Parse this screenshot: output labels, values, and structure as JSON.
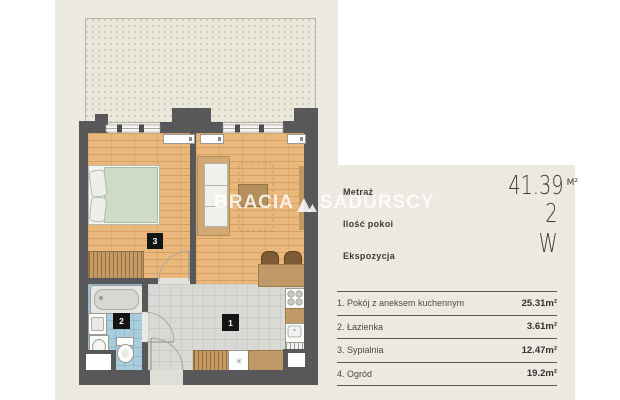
{
  "colors": {
    "background": "#ece9e1",
    "wall": "#58585a",
    "wood_floor": "#ebb87c",
    "tile_gray": "#d9d9d6",
    "tile_blue": "#a8cede",
    "garden_fill": "#eae7db",
    "furniture_brown": "#c09a66",
    "label_black": "#141414"
  },
  "watermark": {
    "left": "BRACIA",
    "right": "SADURSCY",
    "logo": "triangles-logo"
  },
  "stats": [
    {
      "label": "Metraż",
      "value": "41.39",
      "unit": "M²"
    },
    {
      "label": "Ilość pokoi",
      "value": "2",
      "unit": ""
    },
    {
      "label": "Ekspozycja",
      "value": "W",
      "unit": ""
    }
  ],
  "rooms": [
    {
      "name": "1. Pokój z aneksem kuchennym",
      "area": "25.31m²"
    },
    {
      "name": "2. Łazienka",
      "area": "3.61m²"
    },
    {
      "name": "3. Sypialnia",
      "area": "12.47m²"
    },
    {
      "name": "4. Ogród",
      "area": "19.2m²"
    }
  ],
  "plan_labels": {
    "living": "1",
    "bathroom": "2",
    "bedroom": "3"
  },
  "icons": {
    "fan": "✳"
  }
}
